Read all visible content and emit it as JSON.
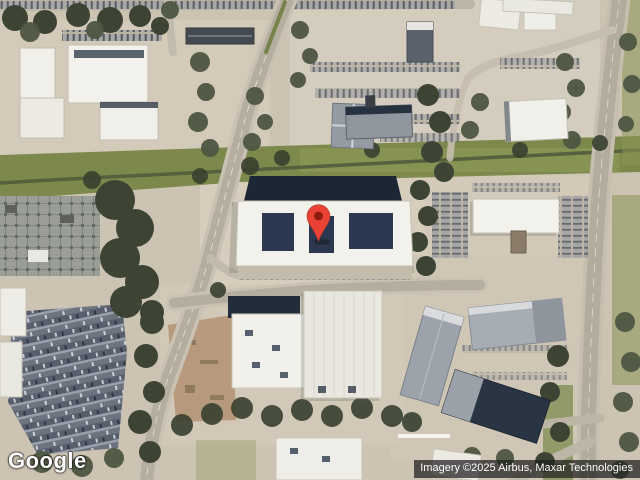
{
  "map": {
    "view_type": "satellite",
    "logo": "Google",
    "attribution": "Imagery ©2025 Airbus, Maxar Technologies",
    "marker": {
      "pin_color": "#EA4335",
      "pin_dot_color": "#8E1B0E"
    }
  }
}
